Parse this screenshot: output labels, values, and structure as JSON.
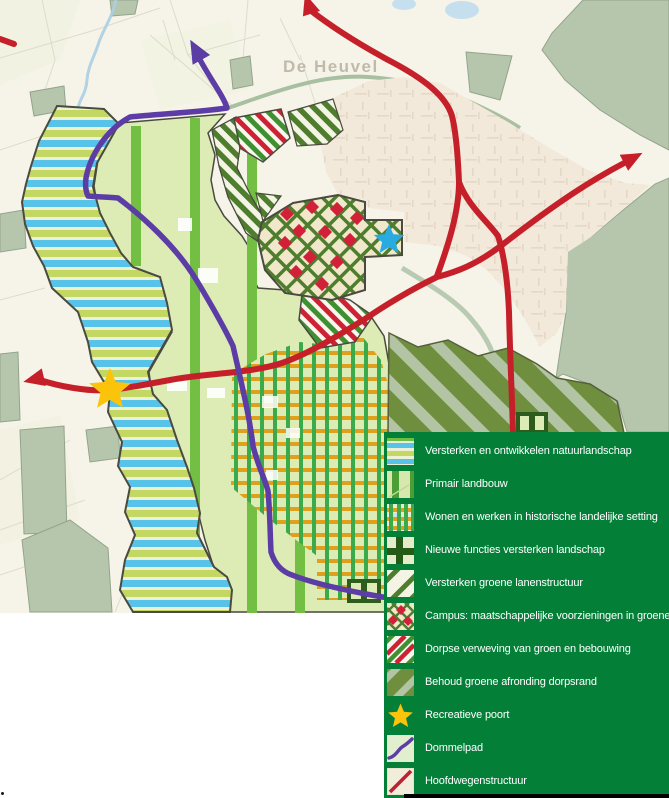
{
  "map": {
    "place_label": "De Heuvel",
    "markers": [
      {
        "name": "recreatieve-poort-star",
        "color": "#fcc30b"
      },
      {
        "name": "campus-star",
        "color": "#29abe2"
      }
    ],
    "route_colors": {
      "hoofdwegenstructuur": "#c5202a",
      "dommelpad": "#5b3da5"
    }
  },
  "legend": {
    "background_color": "#047f38",
    "text_color": "#ffffff",
    "items": [
      {
        "label": "Versterken en ontwikkelen natuurlandschap",
        "swatch": "blue-green-horizontal-stripes"
      },
      {
        "label": "Primair landbouw",
        "swatch": "light-green-with-green-bands"
      },
      {
        "label": "Wonen en werken in historische landelijke setting",
        "swatch": "orange-green-grid"
      },
      {
        "label": "Nieuwe functies versterken landschap",
        "swatch": "dark-green-cross"
      },
      {
        "label": "Versterken groene lanenstructuur",
        "swatch": "green-diagonal-stripes"
      },
      {
        "label": "Campus: maatschappelijke voorzieningen in groene setting",
        "swatch": "green-lattice-red-diamonds"
      },
      {
        "label": "Dorpse verweving van groen en bebouwing",
        "swatch": "red-green-diagonal-stripes"
      },
      {
        "label": "Behoud groene afronding dorpsrand",
        "swatch": "olive-sage-diagonal-stripes"
      },
      {
        "label": "Recreatieve poort",
        "swatch": "yellow-star"
      },
      {
        "label": "Dommelpad",
        "swatch": "purple-path"
      },
      {
        "label": "Hoofdwegenstructuur",
        "swatch": "red-diagonal-line"
      }
    ]
  }
}
